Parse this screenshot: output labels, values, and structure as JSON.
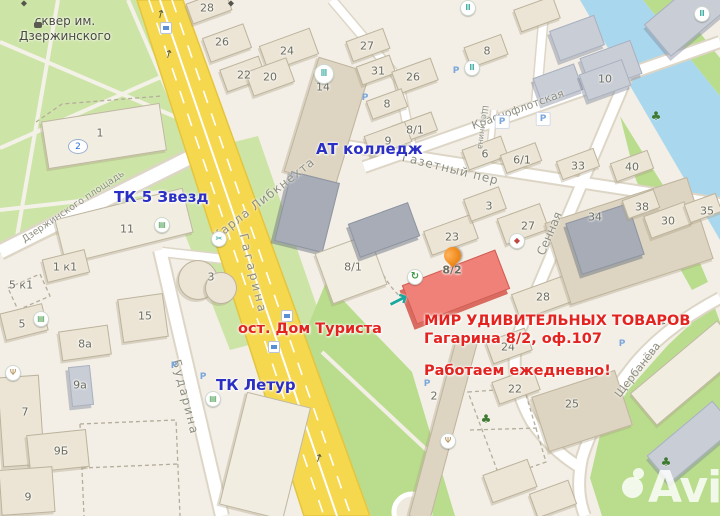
{
  "map": {
    "attribution": "Avito",
    "park": {
      "name": "сквер им. Дзержинского"
    },
    "streets": {
      "karla": "Карла Либкнехта",
      "gagarina": "Гагарина",
      "dzerzh": "Дзержинского площадь",
      "krasno": "Краснофлотская",
      "gazetny": "Газетный пер",
      "shchetinina": "Щетинина",
      "sennaya": "Сенная",
      "shcherbaneva": "Щербанёва",
      "budarina": "Бударина"
    },
    "poi": {
      "tk5": "ТК 5 Звезд",
      "college": "АТ колледж",
      "letur": "ТК Летур"
    },
    "annotations": {
      "stop": "ост. Дом Туриста",
      "line1": "МИР УДИВИТЕЛЬНЫХ ТОВАРОВ",
      "line2": "Гагарина 8/2, оф.107",
      "line3": "Работаем ежедневно!"
    },
    "highlight": {
      "building": "8/2"
    },
    "blds": [
      "1",
      "11",
      "1 к1",
      "5 к1",
      "5",
      "3",
      "15",
      "8а",
      "9а",
      "7",
      "9Б",
      "9",
      "28",
      "26",
      "24",
      "22",
      "20",
      "14",
      "27",
      "31",
      "26",
      "8",
      "8/1",
      "9",
      "6",
      "6/1",
      "33",
      "40",
      "8",
      "10",
      "3",
      "27",
      "23",
      "34",
      "38",
      "30",
      "35",
      "28",
      "24",
      "22",
      "25",
      "2",
      "8/1"
    ],
    "icons": {
      "glyphs": {
        "bank": "Ⅲ",
        "theater": "◆",
        "recycle": "↻",
        "hairdresser": "✂",
        "restaurant": "Ψ",
        "tree": "♣",
        "shop": "▤",
        "parking": "P",
        "road_arrow": "↑",
        "direction_arrow": "→",
        "park_badge": "2",
        "monument": "◆"
      }
    },
    "colors": {
      "accent_red": "#e3231f",
      "poi_blue": "#2b2fc4",
      "highlight_building": "#ef8178",
      "pin_orange": "#f08c1e",
      "road_yellow": "#f6d84f",
      "water": "#a9d7ee",
      "park_green": "#cde4a7",
      "lawn_green": "#b9dd8d"
    }
  }
}
